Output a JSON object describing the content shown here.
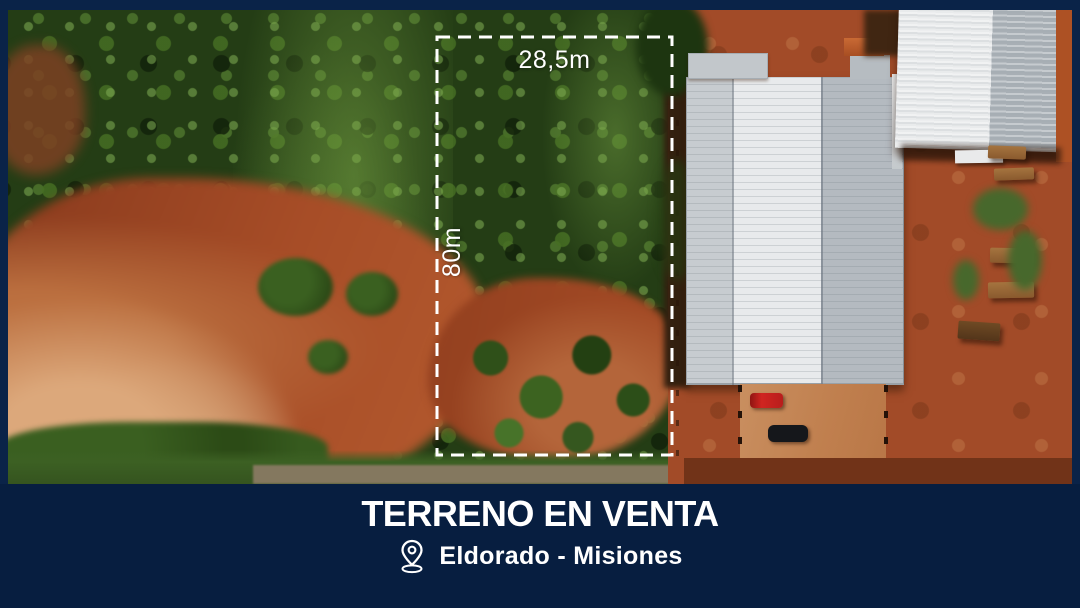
{
  "colors": {
    "frame_bg": "#0a2348",
    "banner_bg": "#071e40",
    "text": "#ffffff",
    "boundary": "#ffffff"
  },
  "overlay": {
    "width_label": "28,5m",
    "depth_label": "80m"
  },
  "banner": {
    "title": "TERRENO EN VENTA",
    "location": "Eldorado - Misiones",
    "location_icon": "map-pin-icon"
  }
}
